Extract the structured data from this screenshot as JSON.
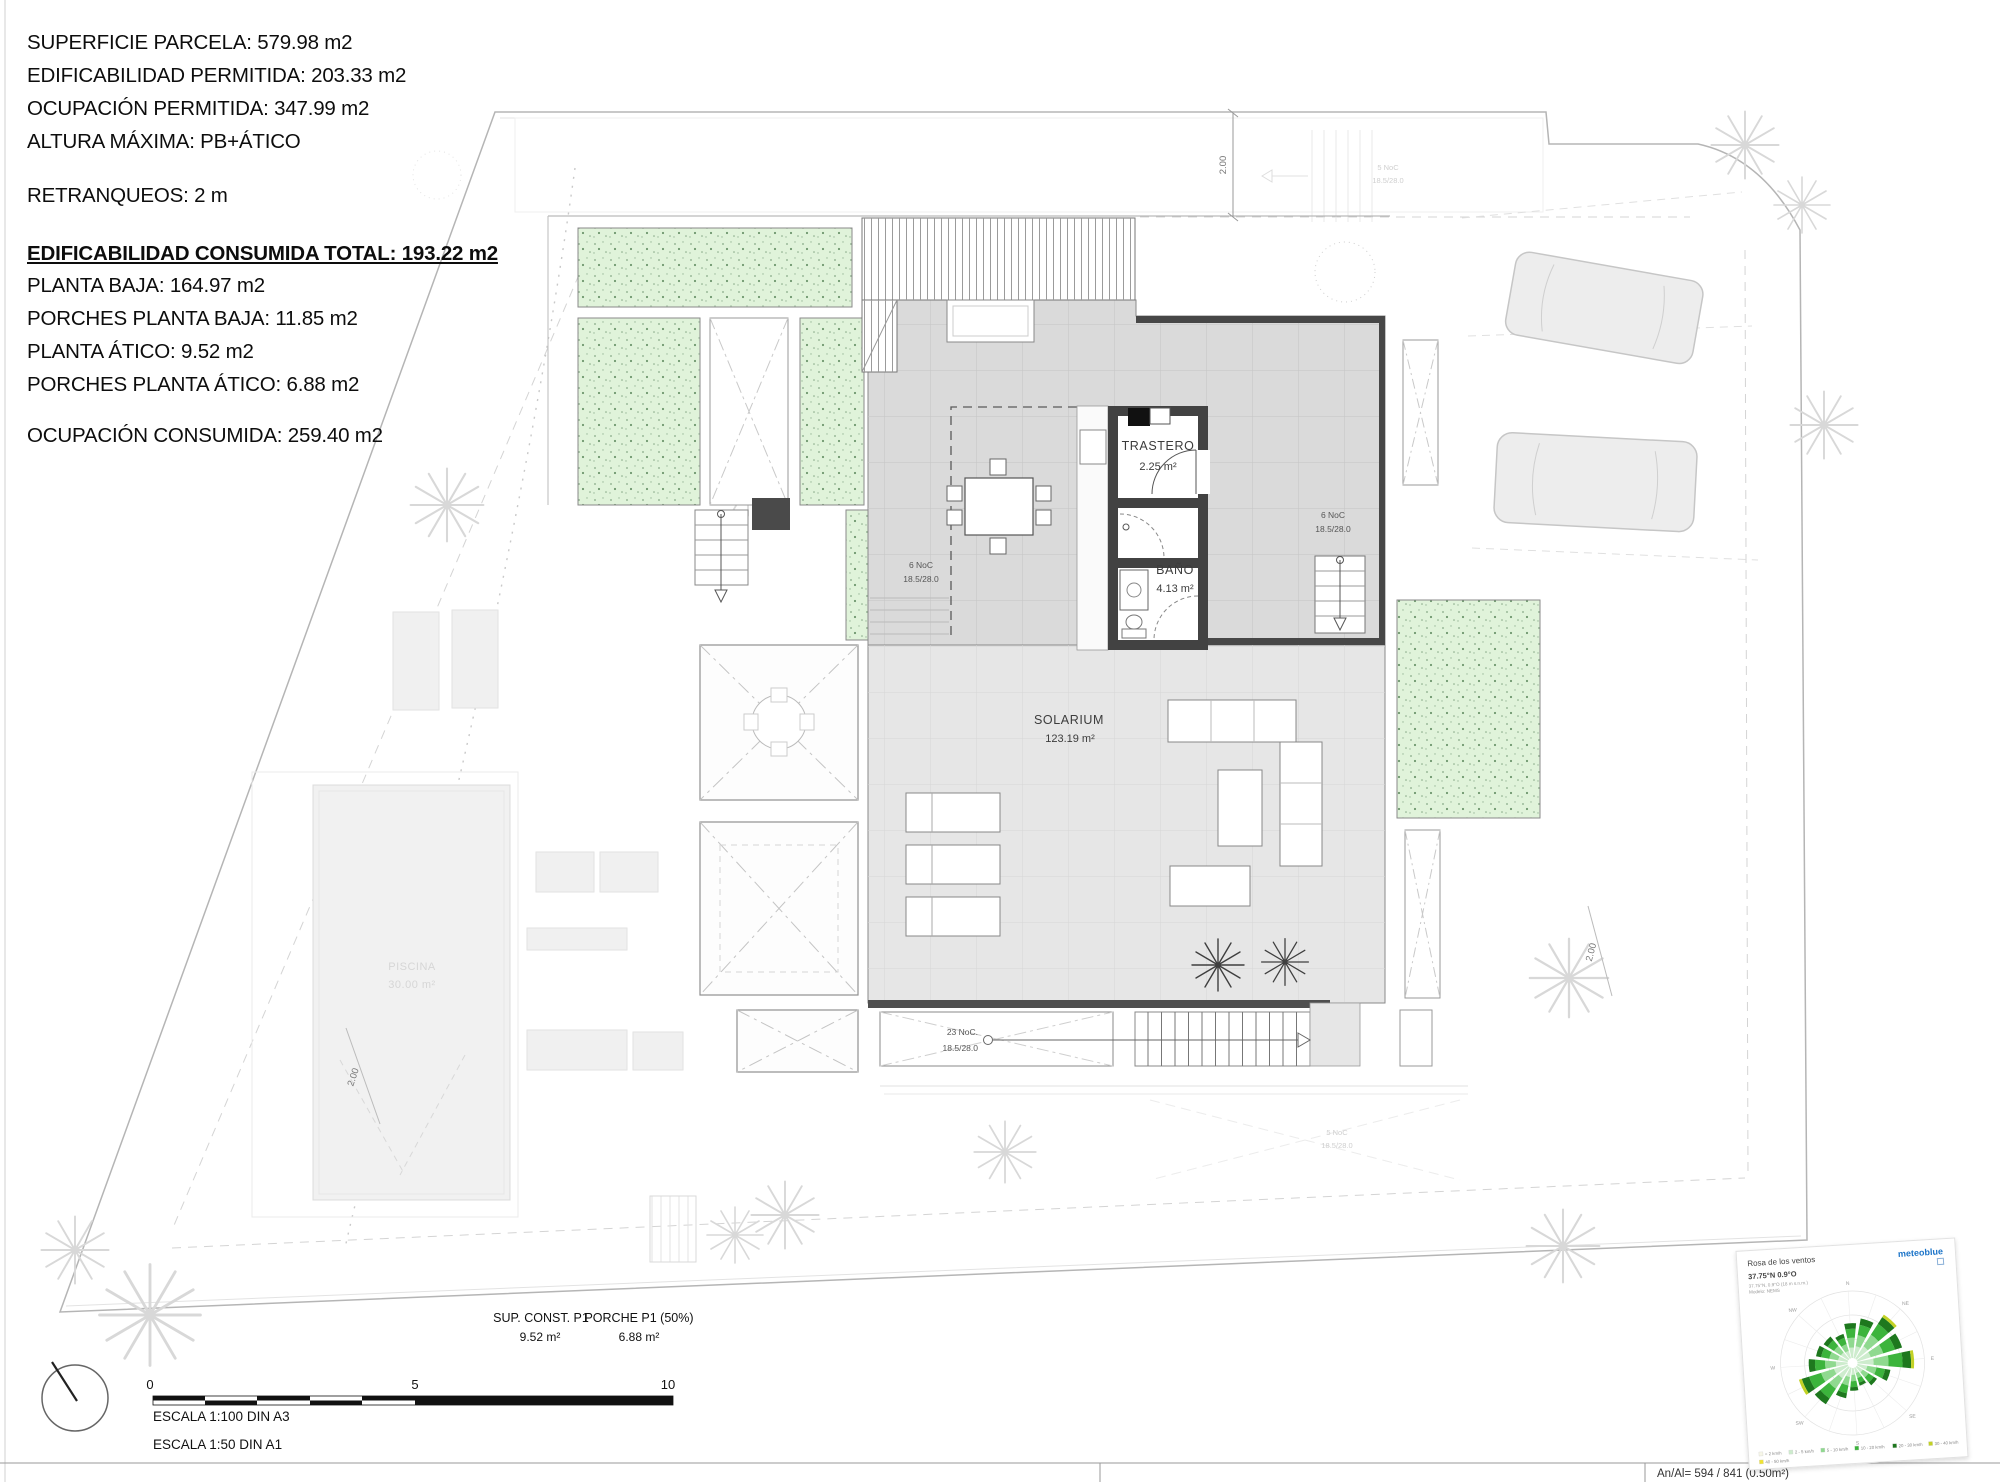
{
  "info": {
    "lines": [
      "SUPERFICIE PARCELA: 579.98 m2",
      "EDIFICABILIDAD PERMITIDA: 203.33 m2",
      "OCUPACIÓN PERMITIDA: 347.99 m2",
      "ALTURA MÁXIMA: PB+ÁTICO",
      "RETRANQUEOS: 2 m",
      "EDIFICABILIDAD CONSUMIDA TOTAL: 193.22 m2",
      "PLANTA BAJA: 164.97 m2",
      "PORCHES PLANTA BAJA: 11.85 m2",
      "PLANTA ÁTICO: 9.52 m2",
      "PORCHES PLANTA ÁTICO: 6.88 m2",
      "OCUPACIÓN CONSUMIDA: 259.40 m2"
    ]
  },
  "plan": {
    "rooms": {
      "trastero": {
        "name": "TRASTERO",
        "area": "2.25 m²"
      },
      "bano": {
        "name": "BAÑO",
        "area": "4.13 m²"
      },
      "solarium": {
        "name": "SOLARIUM",
        "area": "123.19 m²"
      },
      "piscina": {
        "name": "PISCINA",
        "area": "30.00 m²"
      }
    },
    "stairs": {
      "left": {
        "steps": "6 NoC",
        "riser": "18.5/28.0"
      },
      "right": {
        "steps": "6 NoC",
        "riser": "18.5/28.0"
      },
      "bottom": {
        "steps": "23 NoC.",
        "riser": "18.5/28.0"
      },
      "ground_top": {
        "steps": "5 NoC",
        "riser": "18.5/28.0"
      },
      "ground_right": {
        "steps": "5 NoC",
        "riser": "18.5/28.0"
      }
    },
    "dimensions": {
      "top_right": "2.00",
      "right": "2.00",
      "bottom_left": "2.00"
    }
  },
  "bottom": {
    "sup_const": {
      "label": "SUP. CONST. P1",
      "value": "9.52 m²"
    },
    "porche": {
      "label": "PORCHE P1 (50%)",
      "value": "6.88 m²"
    },
    "scale_ticks": [
      "0",
      "5",
      "10"
    ],
    "escala_a3": "ESCALA 1:100 DIN A3",
    "escala_a1": "ESCALA 1:50 DIN A1"
  },
  "footer": {
    "text": "An/Al= 594 / 841 (0.50m²)"
  },
  "windrose": {
    "title": "Rosa de los ventos",
    "logo": "meteoblue",
    "coords": "37.75°N 0.9°O",
    "sub1": "37.75°N, 0.9°O (18 m s.n.m.)",
    "sub2": "Modelo: NEMS",
    "compass": [
      "N",
      "NE",
      "E",
      "SE",
      "S",
      "SW",
      "W",
      "NW"
    ]
  },
  "chart_data": {
    "type": "windrose",
    "title": "Rosa de los ventos",
    "location": "37.75°N 0.9°O",
    "directions": [
      "N",
      "NNE",
      "NE",
      "ENE",
      "E",
      "ESE",
      "SE",
      "SSE",
      "S",
      "SSW",
      "SW",
      "WSW",
      "W",
      "WNW",
      "NW",
      "NNW"
    ],
    "frequency_pct": [
      52,
      60,
      74,
      70,
      80,
      50,
      36,
      28,
      34,
      46,
      66,
      72,
      58,
      48,
      44,
      38
    ],
    "speed_bins": [
      {
        "label": "< 2 km/h",
        "color": "#f7f7e8"
      },
      {
        "label": "2 - 5 km/h",
        "color": "#cdeccd"
      },
      {
        "label": "5 - 10 km/h",
        "color": "#8fd98f"
      },
      {
        "label": "10 - 20 km/h",
        "color": "#3cb43c"
      },
      {
        "label": "20 - 30 km/h",
        "color": "#1e781e"
      },
      {
        "label": "30 - 40 km/h",
        "color": "#c3d225"
      },
      {
        "label": "40 - 50 km/h",
        "color": "#f0e332"
      }
    ],
    "band_fractions": [
      0.3,
      0.28,
      0.26,
      0.16
    ],
    "legend_position": "bottom"
  },
  "colors": {
    "planter": "#e0f3da",
    "terrace": "#dadada",
    "solarium": "#e6e6e6",
    "wall": "#424242",
    "accent_green": "#3cb43c"
  }
}
